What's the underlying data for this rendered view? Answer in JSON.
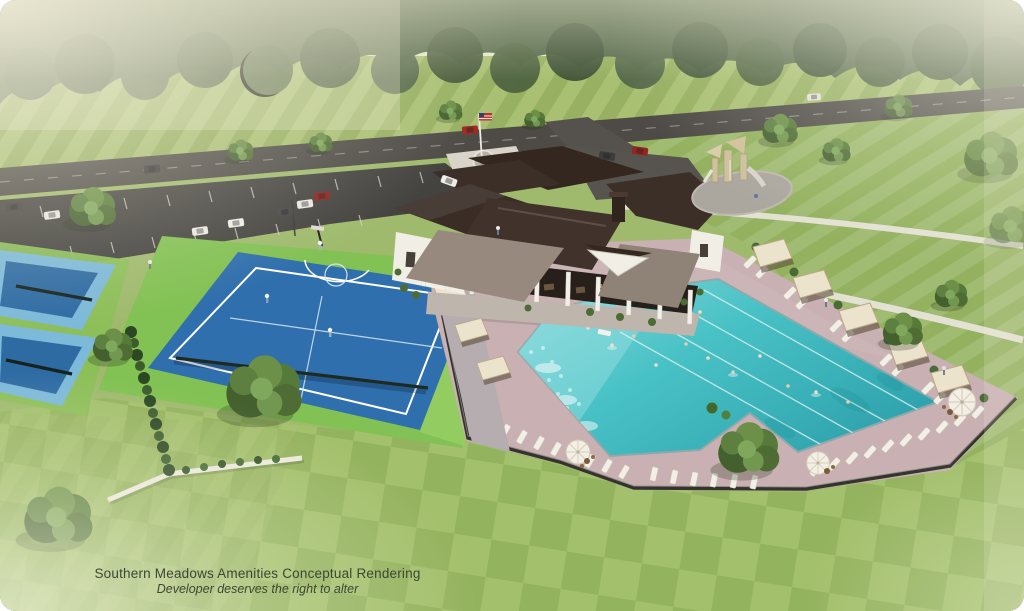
{
  "caption": {
    "line1": "Southern Meadows Amenities Conceptual Rendering",
    "line2": "Developer deserves the right to alter"
  },
  "palette": {
    "sky_haze": "#e6e9cb",
    "tree_dark": "#42543a",
    "tree_mid": "#55684a",
    "lawn_base": "#9fba6d",
    "lawn_stripe_light": "#a9c073",
    "lawn_stripe_dark": "#97b061",
    "checker_light": "#a3c06c",
    "checker_dark": "#94b35e",
    "asphalt": "#4e4b47",
    "parking_asphalt": "#454340",
    "path_concrete": "#e7e4d8",
    "court_apron": "#82c153",
    "court_blue": "#2f6fad",
    "pickleball_border": "#7db9d9",
    "pickleball_blue": "#2e6ba3",
    "pool_water": "#49c2c6",
    "pool_deck": "#c9b0b2",
    "roof_dark": "#3a2d26",
    "porch_roof": "#97897e",
    "wall_white": "#f1eee6",
    "cabana_canopy": "#ece3cd",
    "fence_dark": "#35332f",
    "caption_color": "#3d4634"
  }
}
